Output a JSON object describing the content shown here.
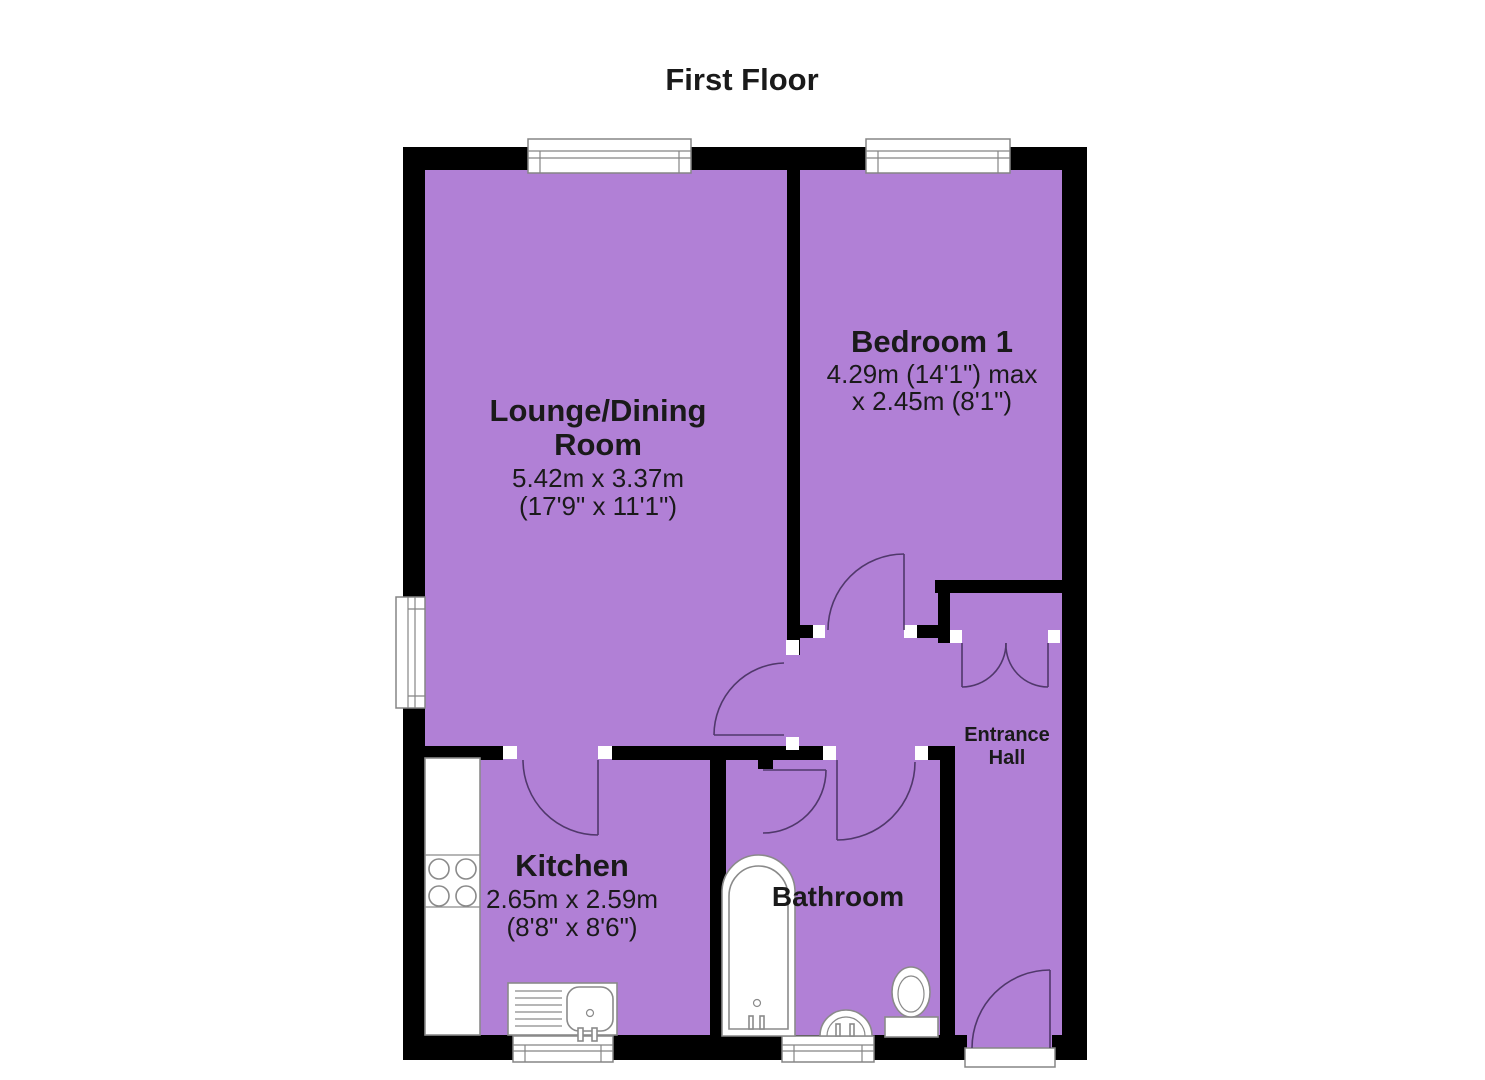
{
  "title": "First Floor",
  "rooms": {
    "lounge": {
      "name_line1": "Lounge/Dining",
      "name_line2": "Room",
      "dim_metric": "5.42m x 3.37m",
      "dim_imperial": "(17'9\" x 11'1\")"
    },
    "bedroom1": {
      "name": "Bedroom 1",
      "dim_line1": "4.29m (14'1\") max",
      "dim_line2": "x 2.45m (8'1\")"
    },
    "kitchen": {
      "name": "Kitchen",
      "dim_metric": "2.65m x 2.59m",
      "dim_imperial": "(8'8\" x 8'6\")"
    },
    "bathroom": {
      "name": "Bathroom"
    },
    "entrance_hall": {
      "name_line1": "Entrance",
      "name_line2": "Hall"
    }
  },
  "fixtures": [
    "bath",
    "toilet",
    "basin",
    "kitchen-sink",
    "hob",
    "worktop"
  ],
  "features": [
    "windows",
    "internal-doors",
    "storage-cupboard",
    "entrance-door"
  ],
  "colors": {
    "room_fill": "#b180d6",
    "wall": "#000000",
    "door_arc": "#50386b",
    "fixture_outline": "#8a8a8a",
    "text": "#1a1a1a",
    "background": "#ffffff"
  }
}
